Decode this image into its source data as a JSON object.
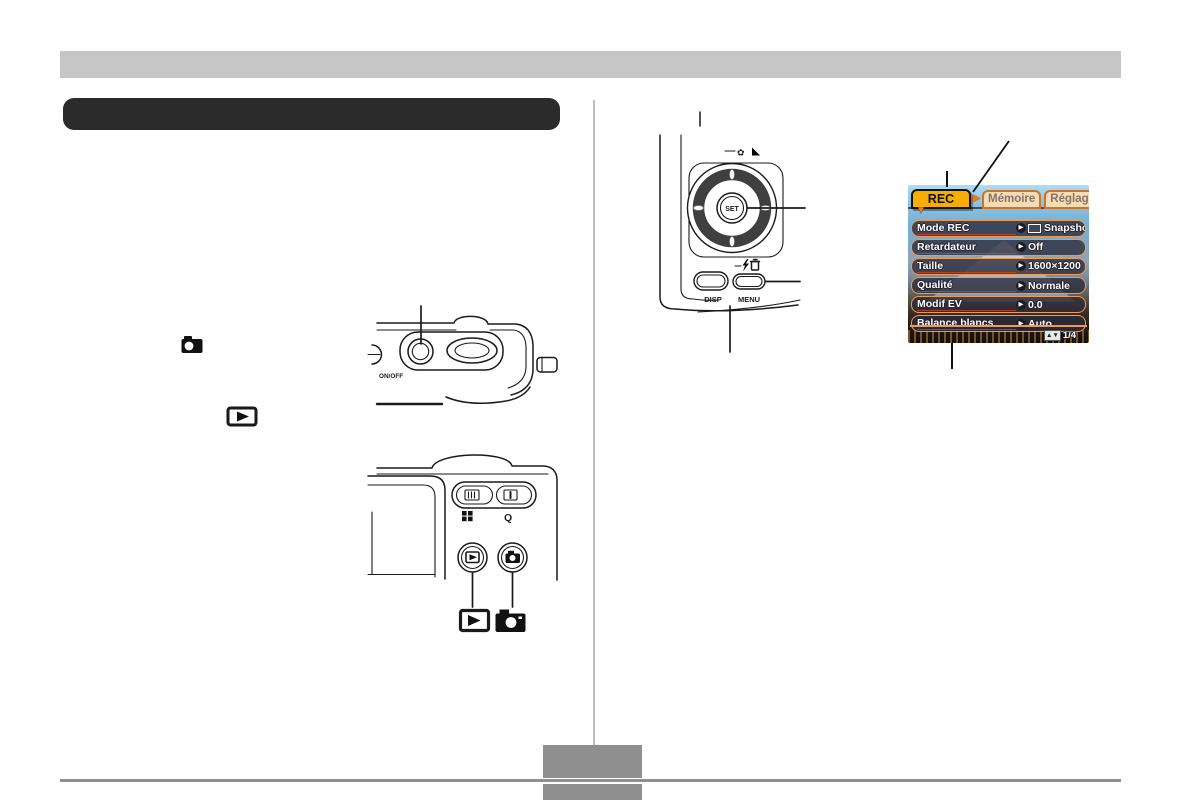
{
  "lcd": {
    "tabs": {
      "rec": "REC",
      "memoire": "Mémoire",
      "reglage": "Réglage"
    },
    "menu": [
      {
        "label": "Mode REC",
        "value": "Snapshot"
      },
      {
        "label": "Retardateur",
        "value": "Off"
      },
      {
        "label": "Taille",
        "value": "1600×1200"
      },
      {
        "label": "Qualité",
        "value": "Normale"
      },
      {
        "label": "Modif EV",
        "value": "0.0"
      },
      {
        "label": "Balance blancs",
        "value": "Auto"
      }
    ],
    "status": {
      "updown": "▲▼",
      "page": "1/4"
    }
  },
  "control_pad": {
    "set": "SET",
    "disp": "DISP",
    "menu": "MENU"
  },
  "camera_top": {
    "power": "ON/OFF"
  },
  "camera_back": {
    "magnify": "Q"
  },
  "icons": {
    "tab_arrow": "▶",
    "tab_pointer": "▼",
    "row_arrow": "▶",
    "macro": "✿"
  },
  "colors": {
    "tab_selected": "#F8AE00",
    "tab_inactive": "#F6DCB4",
    "lcd_accent": "#F09A50",
    "header_bar": "#C6C6C6",
    "title_bar": "#2B2B2B",
    "footer_gray": "#8F8F8F",
    "line_art": "#1A1A1A"
  }
}
